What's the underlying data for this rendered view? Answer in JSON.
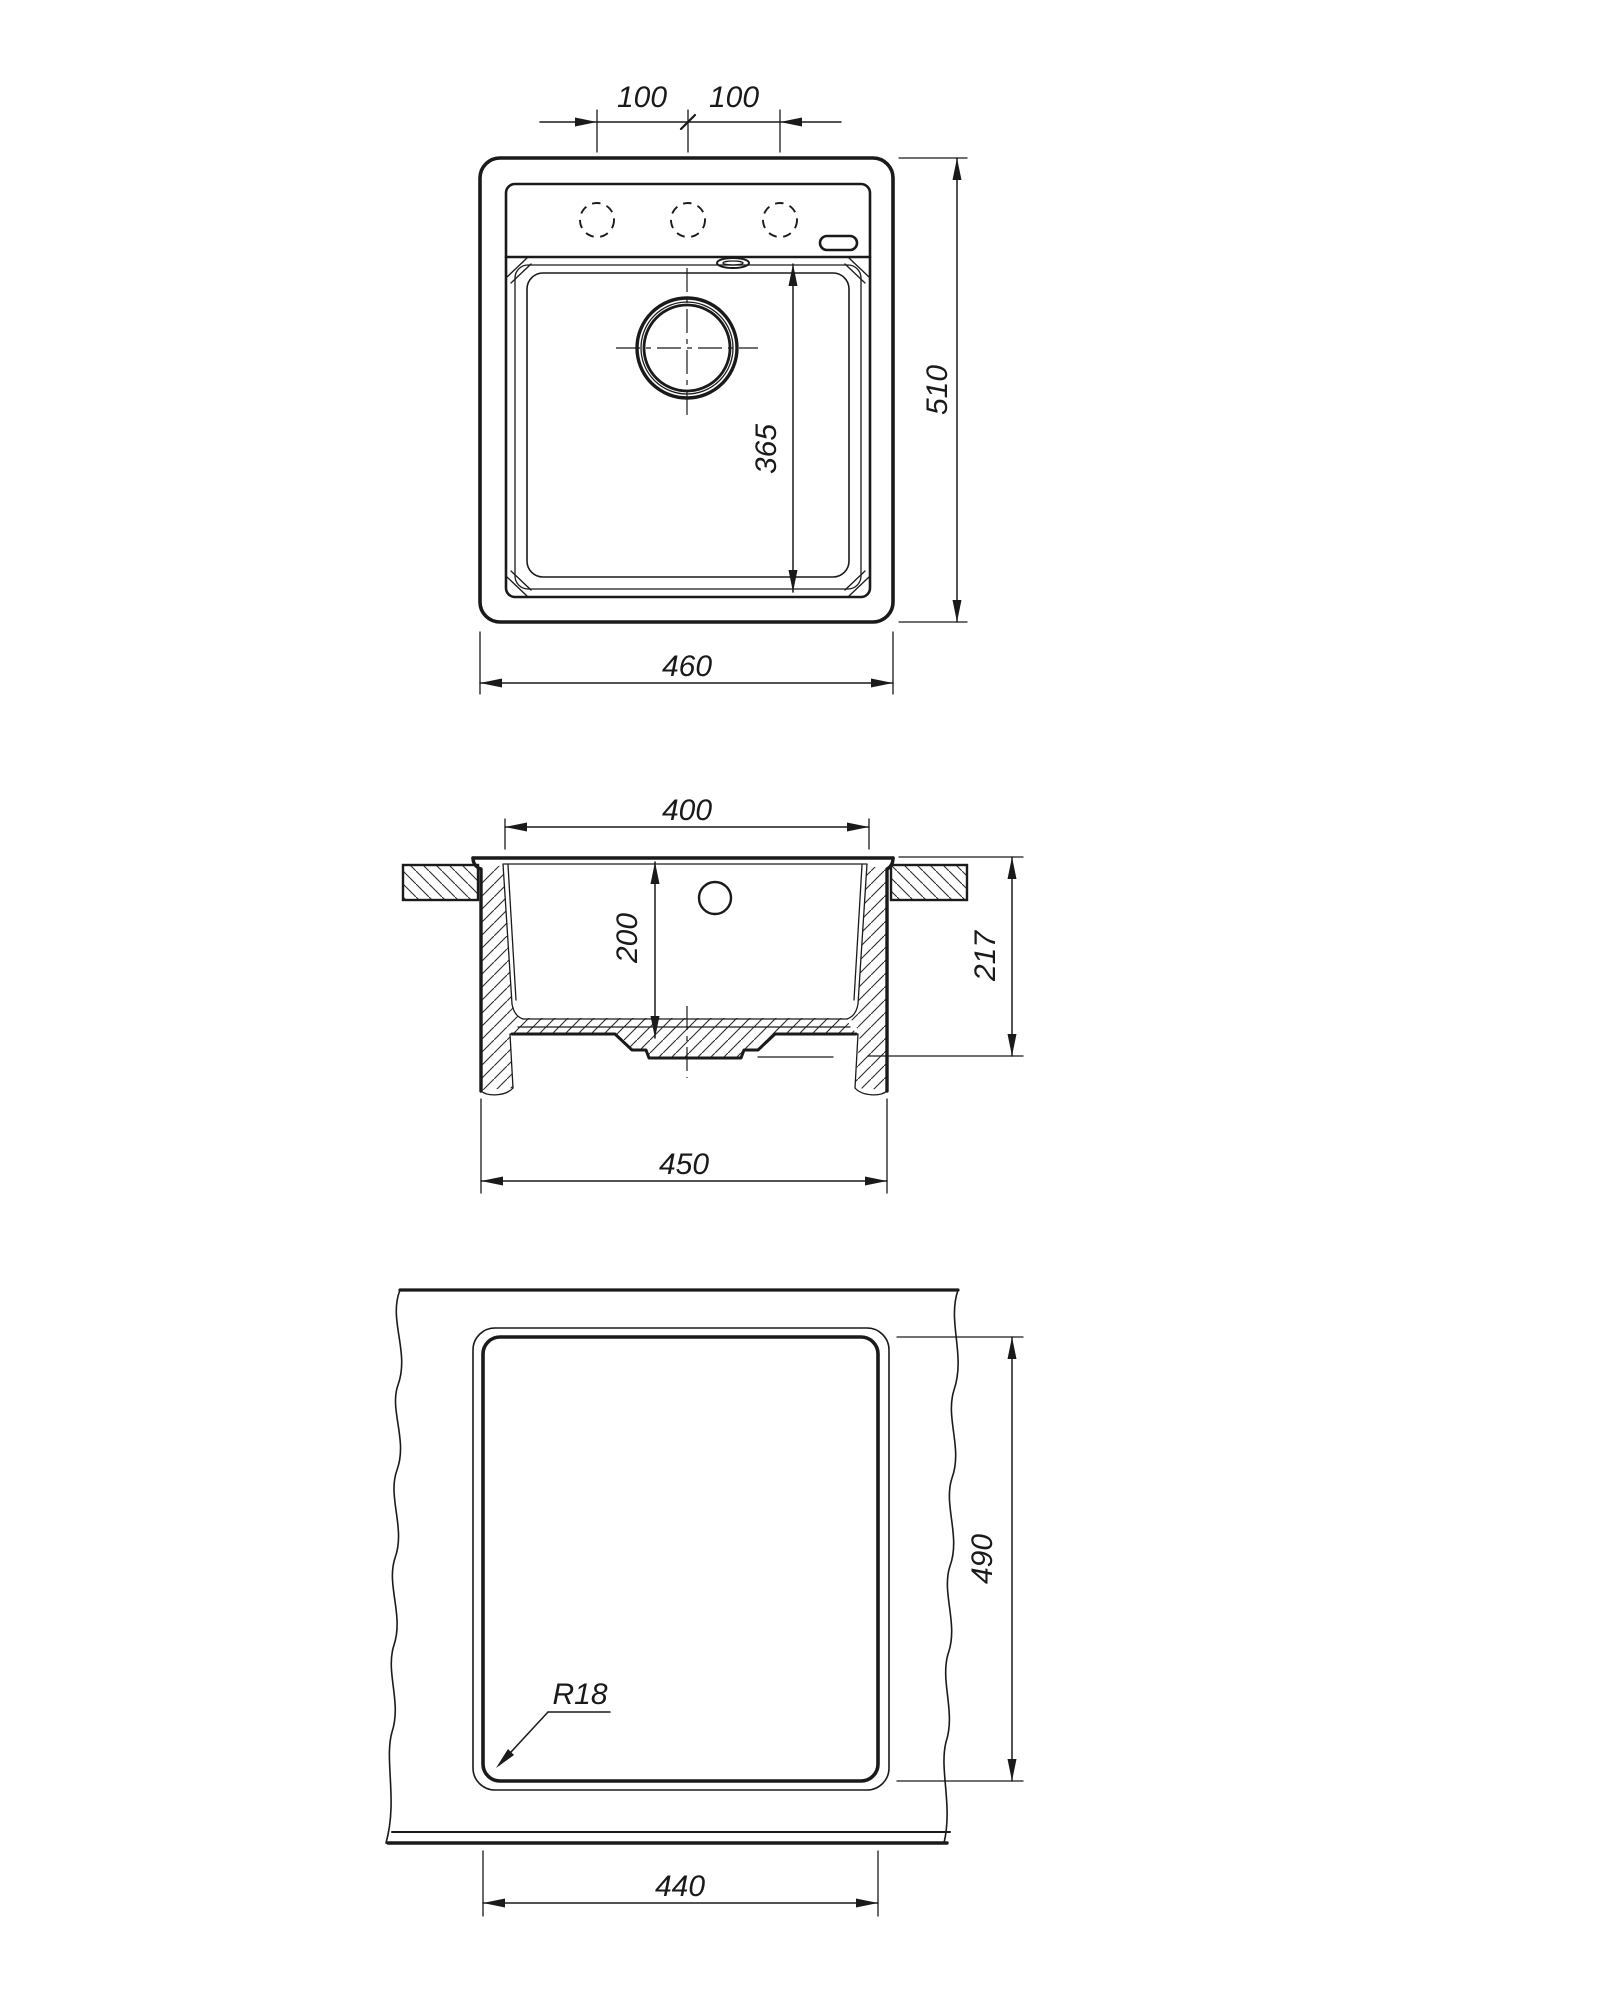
{
  "drawing": {
    "background": "#ffffff",
    "line_color": "#1a1a1a",
    "views": {
      "top_view": {
        "label": "top view",
        "dims": {
          "hole_pitch_left": "100",
          "hole_pitch_right": "100",
          "overall_depth": "510",
          "overall_width": "460",
          "bowl_length": "365"
        }
      },
      "section_view": {
        "label": "front section",
        "dims": {
          "bowl_top_width": "400",
          "bowl_depth": "200",
          "overall_height": "217",
          "body_bottom_width": "450"
        }
      },
      "cutout_view": {
        "label": "countertop cutout",
        "dims": {
          "cutout_depth": "490",
          "cutout_width": "440",
          "corner_radius": "R18"
        }
      }
    }
  }
}
